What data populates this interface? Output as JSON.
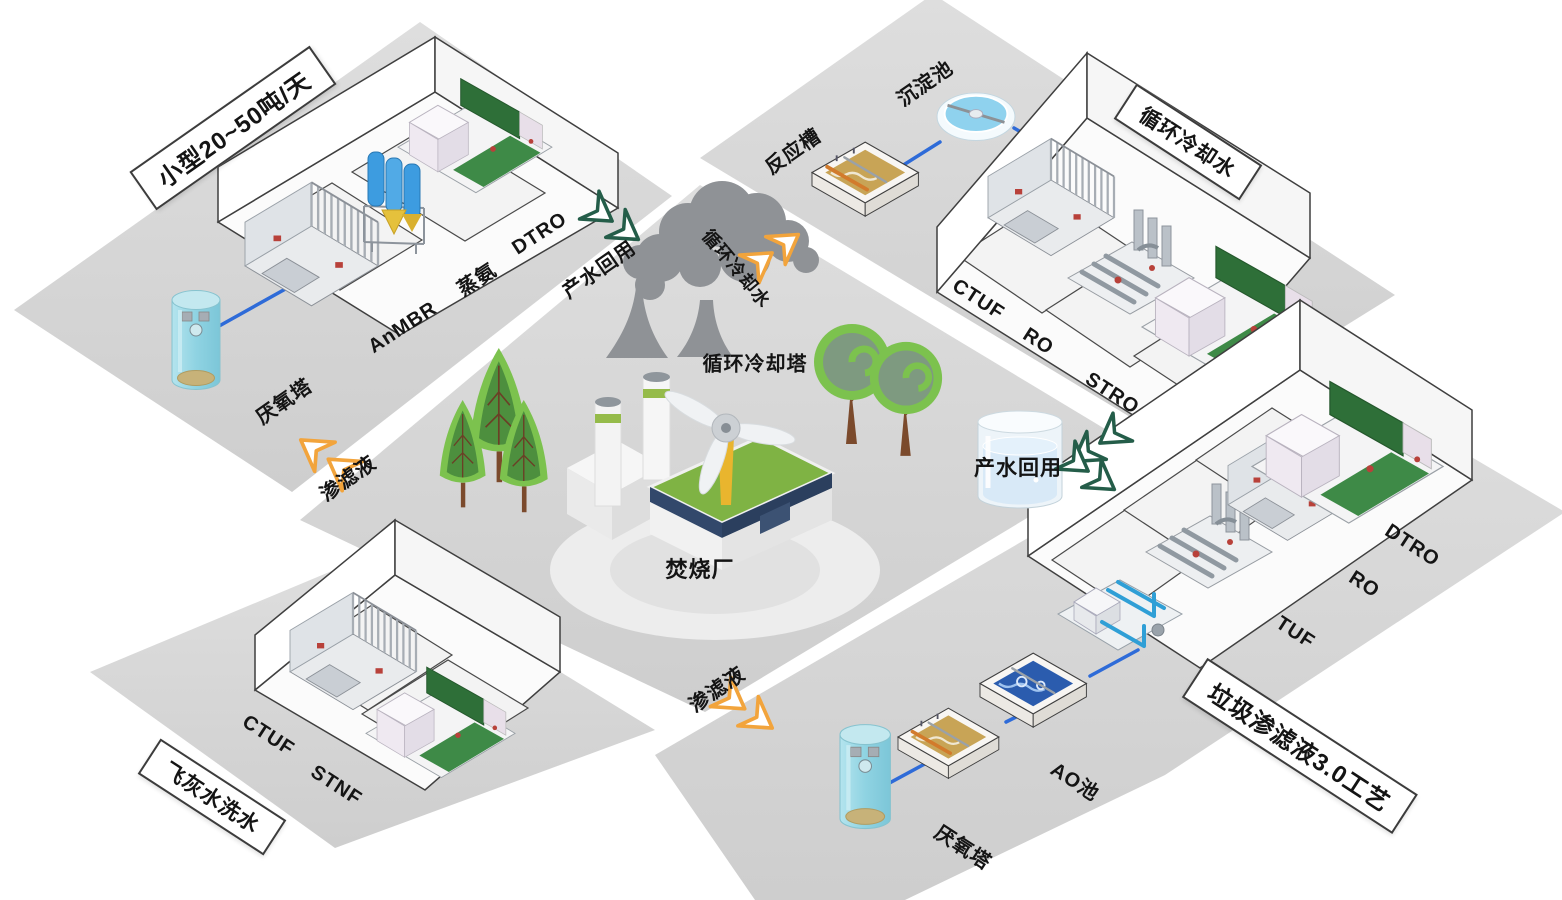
{
  "colors": {
    "platform_grey": "#d7d7d7",
    "pipe_blue": "#2e6bd8",
    "arrow_orange": "#f2a43c",
    "arrow_green": "#245d49",
    "tank_cyan": "#9bd9e6",
    "tree_green": "#7cc24e",
    "smoke_grey": "#8f9296",
    "roof_green": "#7fb344"
  },
  "center": {
    "incineration_plant": "焚烧厂",
    "cooling_tower": "循环冷却塔"
  },
  "flows": {
    "product_water_reuse_left": "产水回用",
    "product_water_reuse_tank": "产水回用",
    "cooling_water": "循环冷却水",
    "leachate_left": "渗滤液",
    "leachate_bottom": "渗滤液"
  },
  "platforms": {
    "small_scale": {
      "plaque": "小型20~50吨/天",
      "units": [
        "AnMBR",
        "蒸氨",
        "DTRO"
      ],
      "anaerobic_tower": "厌氧塔"
    },
    "circulating_cooling": {
      "plaque": "循环冷却水",
      "reaction_tank": "反应槽",
      "sedimentation_tank": "沉淀池",
      "units": [
        "CTUF",
        "RO",
        "STRO"
      ]
    },
    "leachate_30": {
      "plaque": "垃圾渗滤液3.0工艺",
      "units": [
        "MBR",
        "TUF",
        "RO",
        "DTRO"
      ],
      "ao_pool": "AO池",
      "anaerobic_tower": "厌氧塔"
    },
    "fly_ash": {
      "plaque": "飞灰水洗水",
      "units": [
        "CTUF",
        "STNF"
      ]
    }
  }
}
